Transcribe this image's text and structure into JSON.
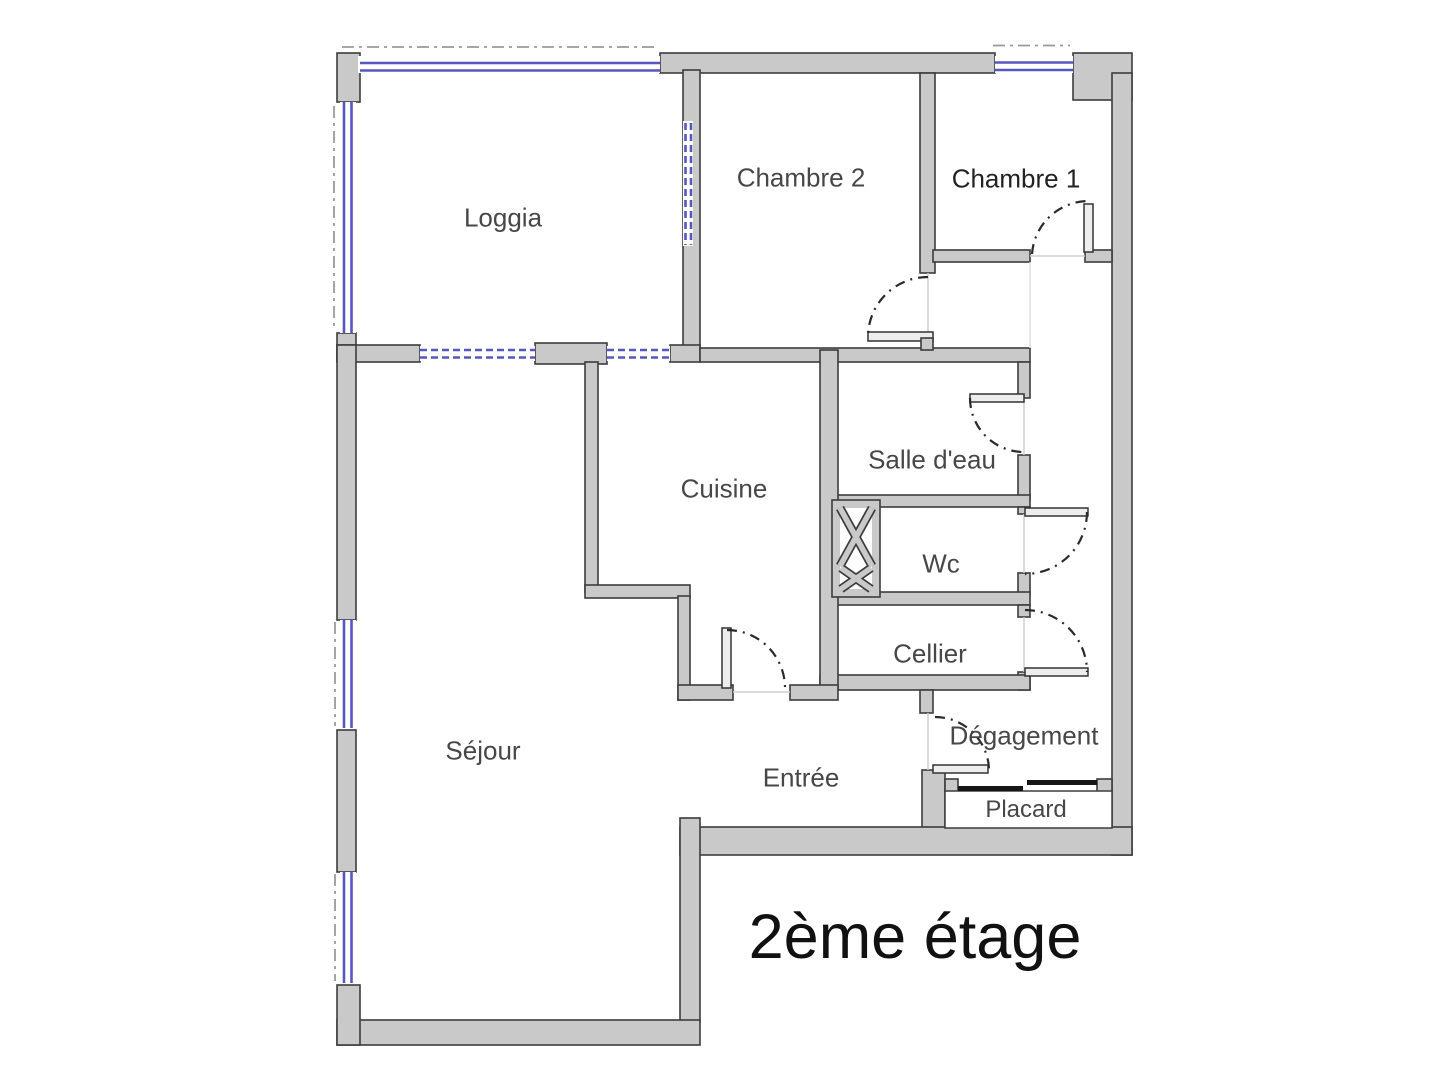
{
  "title": {
    "label": "2ème étage"
  },
  "plan": {
    "rooms": [
      {
        "id": "loggia",
        "label": "Loggia"
      },
      {
        "id": "chambre-2",
        "label": "Chambre 2"
      },
      {
        "id": "chambre-1",
        "label": "Chambre 1"
      },
      {
        "id": "cuisine",
        "label": "Cuisine"
      },
      {
        "id": "salle-deau",
        "label": "Salle d'eau"
      },
      {
        "id": "wc",
        "label": "Wc"
      },
      {
        "id": "cellier",
        "label": "Cellier"
      },
      {
        "id": "sejour",
        "label": "Séjour"
      },
      {
        "id": "entree",
        "label": "Entrée"
      },
      {
        "id": "degagement",
        "label": "Dégagement"
      },
      {
        "id": "placard",
        "label": "Placard"
      }
    ],
    "colors": {
      "wall_fill": "#c9c9c9",
      "wall_outline": "#3d3d3d",
      "window": "#5757c0",
      "door_arc": "#2a2a2a",
      "dash_line": "#9a9a9a"
    }
  }
}
